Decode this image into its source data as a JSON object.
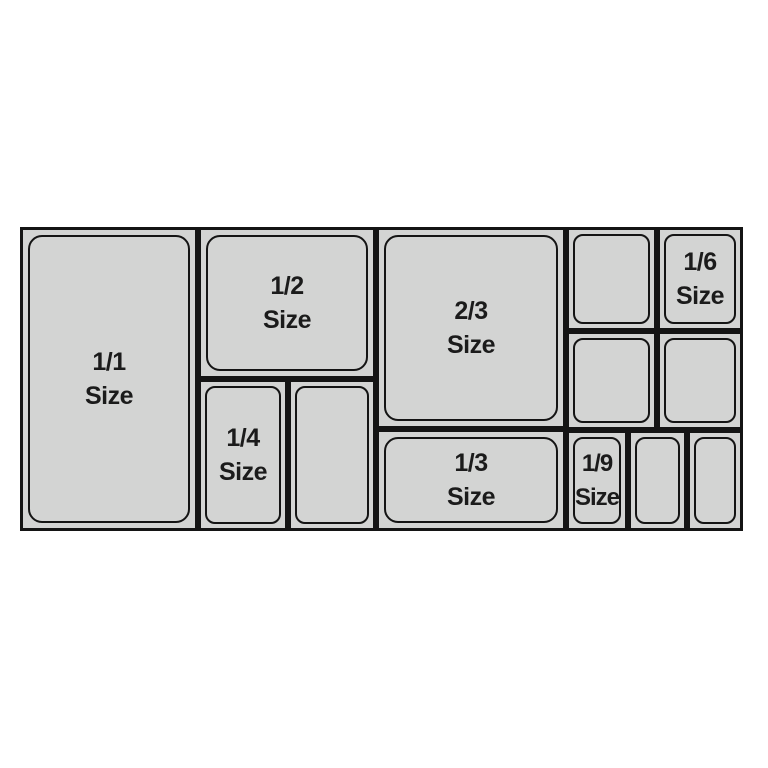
{
  "diagram": {
    "pans": {
      "full": {
        "fraction": "1/1",
        "word": "Size"
      },
      "half": {
        "fraction": "1/2",
        "word": "Size"
      },
      "quarter": {
        "fraction": "1/4",
        "word": "Size"
      },
      "two_thirds": {
        "fraction": "2/3",
        "word": "Size"
      },
      "third": {
        "fraction": "1/3",
        "word": "Size"
      },
      "sixth": {
        "fraction": "1/6",
        "word": "Size"
      },
      "ninth": {
        "fraction": "1/9",
        "word": "Size"
      }
    },
    "colors": {
      "background": "#ffffff",
      "pan_fill": "#d3d4d3",
      "outline": "#141414",
      "text": "#1b1b1b"
    }
  }
}
